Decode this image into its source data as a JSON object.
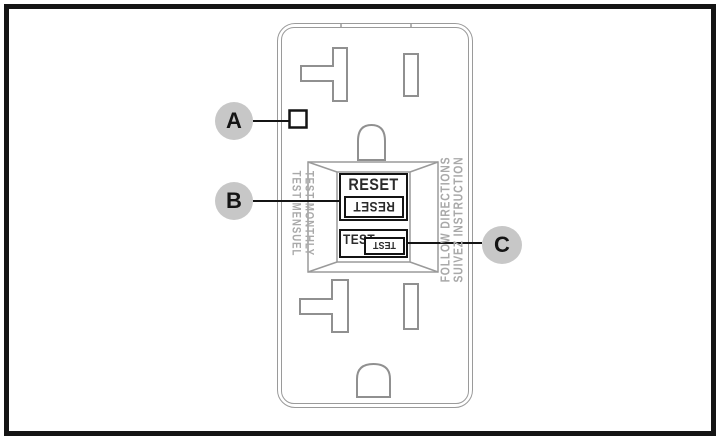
{
  "callouts": {
    "a": {
      "label": "A"
    },
    "b": {
      "label": "B"
    },
    "c": {
      "label": "C"
    }
  },
  "outlet": {
    "reset_button": {
      "label": "RESET",
      "label_inverted": "RESET"
    },
    "test_button": {
      "label": "TEST",
      "label_inverted": "TEST"
    },
    "left_markings": {
      "line1": "TEST MONTHLY",
      "line2": "TEST MENSUEL"
    },
    "right_markings": {
      "line1": "FOLLOW DIRECTIONS",
      "line2": "SUIVEZ INSTRUCTION"
    }
  },
  "colors": {
    "frame": "#141414",
    "outlet_outline": "#9a9a9a",
    "marking_text": "#a9a9a9",
    "button_border": "#141414",
    "callout_bubble": "#c7c7c7",
    "callout_text": "#141414"
  }
}
